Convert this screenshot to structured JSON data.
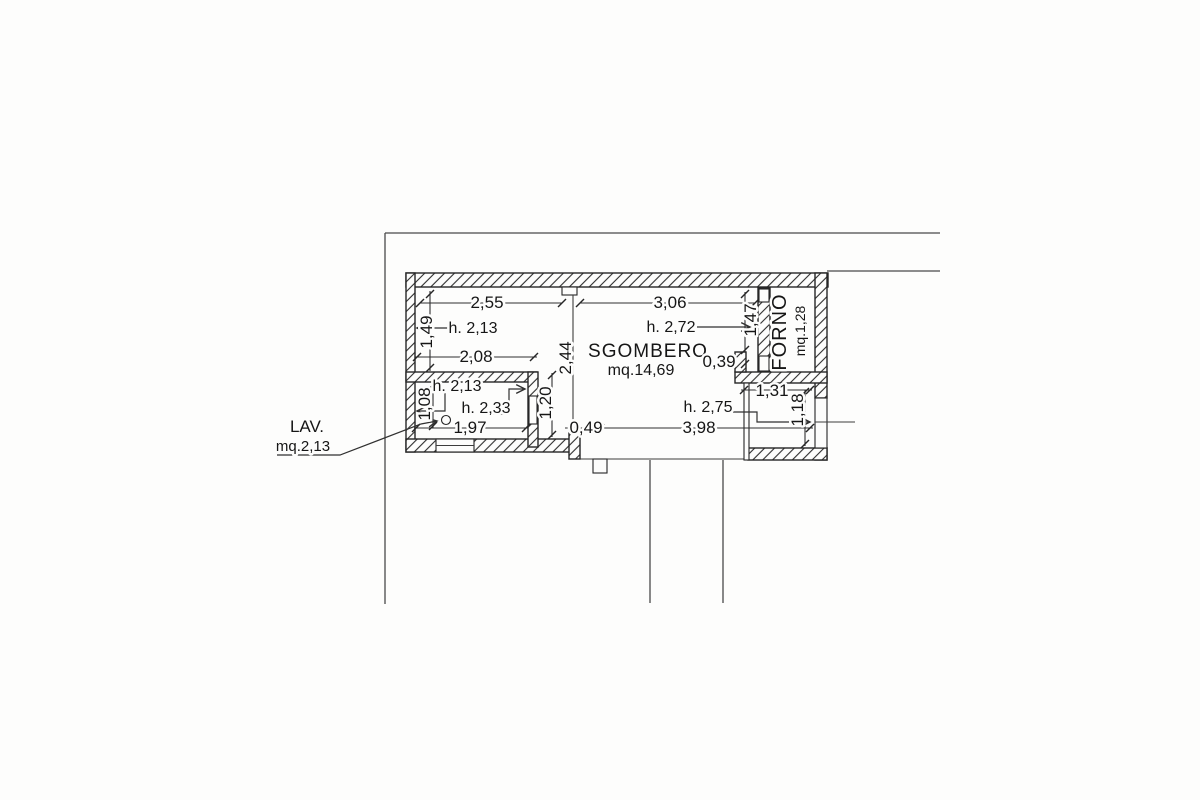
{
  "rooms": {
    "sgombero": {
      "name": "SGOMBERO",
      "area": "mq.14,69"
    },
    "forno": {
      "name": "FORNO",
      "area": "mq.1,28"
    },
    "lav": {
      "name": "LAV.",
      "area": "mq.2,13"
    }
  },
  "dimensions": {
    "w_255": "2,55",
    "w_306": "3,06",
    "v_149": "1,49",
    "w_208": "2,08",
    "v_244": "2,44",
    "v_120": "1,20",
    "v_108": "1,08",
    "w_197": "1,97",
    "w_049": "0,49",
    "w_398": "3,98",
    "v_147": "1,47",
    "w_039": "0,39",
    "w_131": "1,31",
    "v_118": "1,18"
  },
  "heights": {
    "room_left": "h. 2,13",
    "sgombero": "h. 2,72",
    "lav_top": "h. 2,13",
    "lav_inner": "h. 2,33",
    "niche": "h. 2,75"
  },
  "colors": {
    "ink": "#262626",
    "paper": "#fdfdfc",
    "boundary": "#4a4a4a"
  }
}
